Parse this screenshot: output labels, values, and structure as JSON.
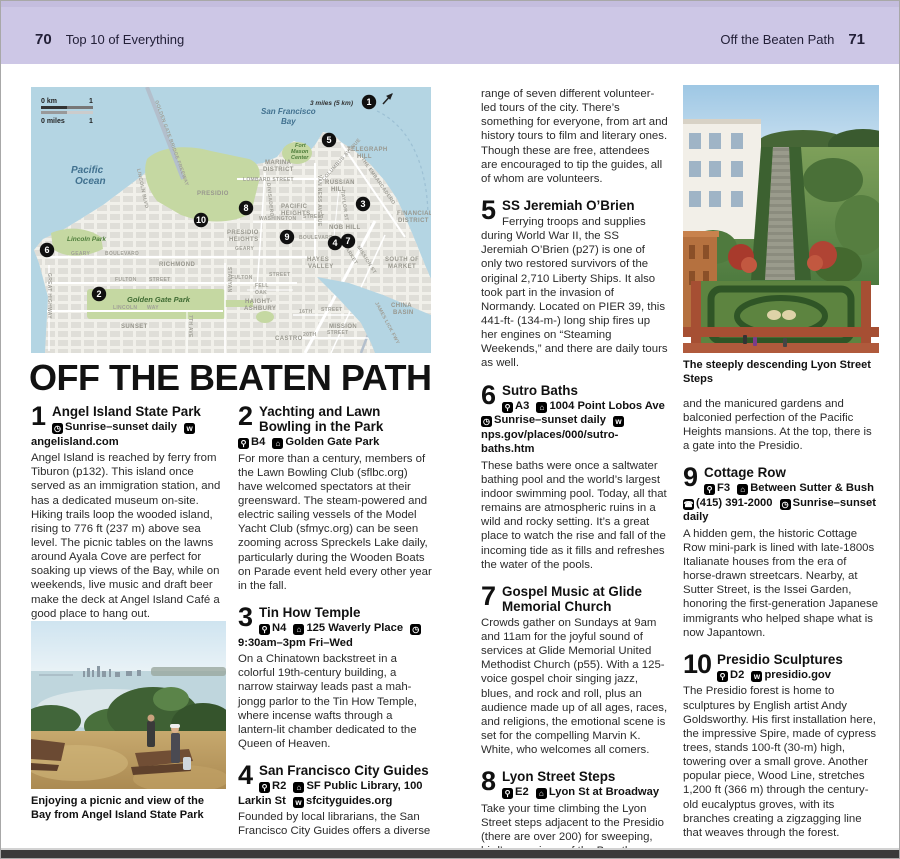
{
  "page": {
    "left_page_number": "70",
    "left_header": "Top 10 of Everything",
    "right_header": "Off the Beaten Path",
    "right_page_number": "71"
  },
  "title": "OFF THE BEATEN PATH",
  "icon_glyphs": {
    "pin": "⚲",
    "building": "⌂",
    "clock": "◷",
    "web": "w",
    "phone": "☎"
  },
  "captions": {
    "picnic": "Enjoying a picnic and view of the Bay from Angel Island State Park",
    "lyon": "The steeply descending Lyon Street Steps"
  },
  "entries": [
    {
      "num": "1",
      "title": "Angel Island State Park",
      "info": [
        {
          "icon": "clock-icon",
          "text": "Sunrise–sunset daily"
        },
        {
          "icon": "web-icon",
          "text": "angelisland.com"
        }
      ],
      "body": "Angel Island is reached by ferry from Tiburon (p132). This island once served as an immigration station, and has a dedicated museum on-site. Hiking trails loop the wooded island, rising to 776 ft (237 m) above sea level. The picnic tables on the lawns around Ayala Cove are perfect for soaking up views of the Bay, while on weekends, live music and draft beer make the deck at Angel Island Café a good place to hang out."
    },
    {
      "num": "2",
      "title": "Yachting and Lawn Bowling in the Park",
      "info": [
        {
          "icon": "map-pin-icon",
          "text": "B4"
        },
        {
          "icon": "building-icon",
          "text": "Golden Gate Park"
        }
      ],
      "body": "For more than a century, members of the Lawn Bowling Club (sflbc.org) have welcomed spectators at their greensward. The steam-powered and electric sailing vessels of the Model Yacht Club (sfmyc.org) can be seen zooming across Spreckels Lake daily, particularly during the Wooden Boats on Parade event held every other year in the fall."
    },
    {
      "num": "3",
      "title": "Tin How Temple",
      "info": [
        {
          "icon": "map-pin-icon",
          "text": "N4"
        },
        {
          "icon": "building-icon",
          "text": "125 Waverly Place"
        },
        {
          "icon": "clock-icon",
          "text": "9:30am–3pm Fri–Wed"
        }
      ],
      "body": "On a Chinatown backstreet in a colorful 19th-century building, a narrow stairway leads past a mah-jongg parlor to the Tin How Temple, where incense wafts through a lantern-lit chamber dedicated to the Queen of Heaven."
    },
    {
      "num": "4",
      "title": "San Francisco City Guides",
      "info": [
        {
          "icon": "map-pin-icon",
          "text": "R2"
        },
        {
          "icon": "building-icon",
          "text": "SF Public Library, 100 Larkin St"
        },
        {
          "icon": "web-icon",
          "text": "sfcityguides.org"
        }
      ],
      "body": "Founded by local librarians, the San Francisco City Guides offers a diverse",
      "body_cont": "range of seven different volunteer-led tours of the city. There’s something for everyone, from art and history tours to film and literary ones. Though these are free, attendees are encouraged to tip the guides, all of whom are volunteers."
    },
    {
      "num": "5",
      "title": "SS Jeremiah O’Brien",
      "info": [],
      "body": "Ferrying troops and supplies during World War II, the SS Jeremiah O’Brien (p27) is one of only two restored survivors of the original 2,710 Liberty Ships. It also took part in the invasion of Normandy. Located on PIER 39, this 441-ft- (134-m-) long ship fires up her engines on “Steaming Weekends,” and there are daily tours as well."
    },
    {
      "num": "6",
      "title": "Sutro Baths",
      "info": [
        {
          "icon": "map-pin-icon",
          "text": "A3"
        },
        {
          "icon": "building-icon",
          "text": "1004 Point Lobos Ave"
        },
        {
          "icon": "clock-icon",
          "text": "Sunrise–sunset daily"
        },
        {
          "icon": "web-icon",
          "text": "nps.gov/places/000/sutro-baths.htm"
        }
      ],
      "body": "These baths were once a saltwater bathing pool and the world’s largest indoor swimming pool. Today, all that remains are atmospheric ruins in a wild and rocky setting. It’s a great place to watch the rise and fall of the incoming tide as it fills and refreshes the water of the pools."
    },
    {
      "num": "7",
      "title": "Gospel Music at Glide Memorial Church",
      "info": [],
      "body": "Crowds gather on Sundays at 9am and 11am for the joyful sound of services at Glide Memorial United Methodist Church (p55). With a 125-voice gospel choir singing jazz, blues, and rock and roll, plus an audience made up of all ages, races, and religions, the emotional scene is set for the compelling Marvin K. White, who welcomes all comers."
    },
    {
      "num": "8",
      "title": "Lyon Street Steps",
      "info": [
        {
          "icon": "map-pin-icon",
          "text": "E2"
        },
        {
          "icon": "building-icon",
          "text": "Lyon St at Broadway"
        }
      ],
      "body": "Take your time climbing the Lyon Street steps adjacent to the Presidio (there are over 200) for sweeping, bird’s-eye views of the Bay, the Presidio, the Palace of Fine Arts,",
      "body_cont": "and the manicured gardens and balconied perfection of the Pacific Heights mansions. At the top, there is a gate into the Presidio."
    },
    {
      "num": "9",
      "title": "Cottage Row",
      "info": [
        {
          "icon": "map-pin-icon",
          "text": "F3"
        },
        {
          "icon": "building-icon",
          "text": "Between Sutter & Bush"
        },
        {
          "icon": "phone-icon",
          "text": "(415) 391-2000"
        },
        {
          "icon": "clock-icon",
          "text": "Sunrise–sunset daily"
        }
      ],
      "body": "A hidden gem, the historic Cottage Row mini-park is lined with late-1800s Italianate houses from the era of horse-drawn streetcars. Nearby, at Sutter Street, is the Issei Garden, honoring the first-generation Japanese immigrants who helped shape what is now Japantown."
    },
    {
      "num": "10",
      "title": "Presidio Sculptures",
      "info": [
        {
          "icon": "map-pin-icon",
          "text": "D2"
        },
        {
          "icon": "web-icon",
          "text": "presidio.gov"
        }
      ],
      "body": "The Presidio forest is home to sculptures by English artist Andy Goldsworthy. His first installation here, the impressive Spire, made of cypress trees, stands 100-ft (30-m) high, towering over a small grove. Another popular piece, Wood Line, stretches 1,200 ft (366 m) through the century-old eucalyptus groves, with its branches creating a zigzagging line that weaves through the forest."
    }
  ],
  "map": {
    "scale": {
      "km_label": "0 km",
      "km_value": "1",
      "miles_label": "0 miles",
      "miles_value": "1"
    },
    "distance_note": "3 miles (5 km)",
    "colors": {
      "water": "#b4d5e3",
      "land": "#f1f0ea",
      "park": "#c5d8a2",
      "marker": "#101010"
    },
    "markers": [
      {
        "n": "1",
        "x": 338,
        "y": 15
      },
      {
        "n": "2",
        "x": 68,
        "y": 207
      },
      {
        "n": "3",
        "x": 332,
        "y": 117
      },
      {
        "n": "4",
        "x": 304,
        "y": 156
      },
      {
        "n": "5",
        "x": 298,
        "y": 53
      },
      {
        "n": "6",
        "x": 16,
        "y": 163
      },
      {
        "n": "7",
        "x": 317,
        "y": 154
      },
      {
        "n": "8",
        "x": 215,
        "y": 121
      },
      {
        "n": "9",
        "x": 256,
        "y": 150
      },
      {
        "n": "10",
        "x": 170,
        "y": 133
      }
    ],
    "labels": [
      {
        "kind": "water",
        "text": "Pacific",
        "x": 40,
        "y": 86
      },
      {
        "kind": "water",
        "text": "Ocean",
        "x": 44,
        "y": 97
      },
      {
        "kind": "bay",
        "text": "San Francisco",
        "x": 230,
        "y": 27
      },
      {
        "kind": "bay",
        "text": "Bay",
        "x": 250,
        "y": 37
      },
      {
        "kind": "note",
        "text": "3 miles (5 km)",
        "x": 322,
        "y": 18
      },
      {
        "kind": "district",
        "text": "MARINA",
        "x": 234,
        "y": 77
      },
      {
        "kind": "district",
        "text": "DISTRICT",
        "x": 232,
        "y": 84
      },
      {
        "kind": "district",
        "text": "TELEGRAPH",
        "x": 316,
        "y": 64
      },
      {
        "kind": "district",
        "text": "HILL",
        "x": 326,
        "y": 71
      },
      {
        "kind": "district",
        "text": "RUSSIAN",
        "x": 294,
        "y": 97
      },
      {
        "kind": "district",
        "text": "HILL",
        "x": 300,
        "y": 104
      },
      {
        "kind": "district",
        "text": "PACIFIC",
        "x": 250,
        "y": 121
      },
      {
        "kind": "district",
        "text": "HEIGHTS",
        "x": 250,
        "y": 128
      },
      {
        "kind": "district",
        "text": "NOB HILL",
        "x": 298,
        "y": 142
      },
      {
        "kind": "district",
        "text": "FINANCIAL",
        "x": 366,
        "y": 128
      },
      {
        "kind": "district",
        "text": "DISTRICT",
        "x": 367,
        "y": 135
      },
      {
        "kind": "district",
        "text": "PRESIDIO",
        "x": 166,
        "y": 108
      },
      {
        "kind": "district",
        "text": "PRESIDIO",
        "x": 196,
        "y": 147
      },
      {
        "kind": "district",
        "text": "HEIGHTS",
        "x": 198,
        "y": 154
      },
      {
        "kind": "district",
        "text": "RICHMOND",
        "x": 128,
        "y": 179
      },
      {
        "kind": "district",
        "text": "HAYES",
        "x": 276,
        "y": 174
      },
      {
        "kind": "district",
        "text": "VALLEY",
        "x": 277,
        "y": 181
      },
      {
        "kind": "district",
        "text": "SOUTH OF",
        "x": 354,
        "y": 174
      },
      {
        "kind": "district",
        "text": "MARKET",
        "x": 357,
        "y": 181
      },
      {
        "kind": "district",
        "text": "HAIGHT-",
        "x": 214,
        "y": 216
      },
      {
        "kind": "district",
        "text": "ASHBURY",
        "x": 213,
        "y": 223
      },
      {
        "kind": "district",
        "text": "SUNSET",
        "x": 90,
        "y": 241
      },
      {
        "kind": "district",
        "text": "CASTRO",
        "x": 244,
        "y": 253
      },
      {
        "kind": "district",
        "text": "MISSION",
        "x": 298,
        "y": 241
      },
      {
        "kind": "district",
        "text": "CHINA",
        "x": 360,
        "y": 220
      },
      {
        "kind": "district",
        "text": "BASIN",
        "x": 362,
        "y": 227
      },
      {
        "kind": "park",
        "text": "Lincoln Park",
        "x": 36,
        "y": 154
      },
      {
        "kind": "gpark",
        "text": "Golden Gate Park",
        "x": 96,
        "y": 215
      },
      {
        "kind": "fort",
        "text": "Fort",
        "x": 264,
        "y": 60
      },
      {
        "kind": "fort",
        "text": "Mason",
        "x": 260,
        "y": 66
      },
      {
        "kind": "fort",
        "text": "Center",
        "x": 260,
        "y": 72
      },
      {
        "kind": "street",
        "text": "LOMBARD STREET",
        "x": 212,
        "y": 94
      },
      {
        "kind": "street",
        "text": "COLUMBUS AVENUE",
        "x": 293,
        "y": 94,
        "rotate": -48
      },
      {
        "kind": "street",
        "text": "THE EMBARCADERO",
        "x": 330,
        "y": 72,
        "rotate": 55
      },
      {
        "kind": "street",
        "text": "VAN NESS AVENUE",
        "x": 287,
        "y": 88,
        "rotate": 90
      },
      {
        "kind": "street",
        "text": "TAYLOR ST",
        "x": 310,
        "y": 104,
        "rotate": 82
      },
      {
        "kind": "street",
        "text": "WASHINGTON",
        "x": 228,
        "y": 133
      },
      {
        "kind": "street",
        "text": "STREET",
        "x": 272,
        "y": 131
      },
      {
        "kind": "street",
        "text": "BOULEVARD",
        "x": 268,
        "y": 152
      },
      {
        "kind": "street",
        "text": "GEARY",
        "x": 204,
        "y": 163
      },
      {
        "kind": "street",
        "text": "GEARY",
        "x": 40,
        "y": 168
      },
      {
        "kind": "street",
        "text": "BOULEVARD",
        "x": 74,
        "y": 168
      },
      {
        "kind": "street",
        "text": "FULTON",
        "x": 84,
        "y": 194
      },
      {
        "kind": "street",
        "text": "STREET",
        "x": 118,
        "y": 194
      },
      {
        "kind": "street",
        "text": "FULTON",
        "x": 200,
        "y": 192
      },
      {
        "kind": "street",
        "text": "STREET",
        "x": 238,
        "y": 189
      },
      {
        "kind": "street",
        "text": "FELL",
        "x": 224,
        "y": 200
      },
      {
        "kind": "street",
        "text": "OAK",
        "x": 224,
        "y": 207
      },
      {
        "kind": "street",
        "text": "LINCOLN",
        "x": 82,
        "y": 222
      },
      {
        "kind": "street",
        "text": "WAY",
        "x": 116,
        "y": 222
      },
      {
        "kind": "street",
        "text": "16TH",
        "x": 268,
        "y": 226
      },
      {
        "kind": "street",
        "text": "STREET",
        "x": 290,
        "y": 224
      },
      {
        "kind": "street",
        "text": "20TH",
        "x": 272,
        "y": 249
      },
      {
        "kind": "street",
        "text": "STREET",
        "x": 296,
        "y": 247
      },
      {
        "kind": "street",
        "text": "STANYAN",
        "x": 197,
        "y": 180,
        "rotate": 90
      },
      {
        "kind": "street",
        "text": "DIVISADERO",
        "x": 236,
        "y": 96,
        "rotate": 84
      },
      {
        "kind": "street",
        "text": "MARKET",
        "x": 312,
        "y": 158,
        "rotate": 58
      },
      {
        "kind": "street",
        "text": "MISSION ST",
        "x": 326,
        "y": 160,
        "rotate": 58
      },
      {
        "kind": "street",
        "text": "GOLDEN GATE BRIDGE FREEWAY",
        "x": 124,
        "y": 14,
        "rotate": 70
      },
      {
        "kind": "street",
        "text": "LINCOLN BLVD",
        "x": 106,
        "y": 82,
        "rotate": 78
      },
      {
        "kind": "street",
        "text": "GREAT HIGHWAY",
        "x": 17,
        "y": 186,
        "rotate": 90
      },
      {
        "kind": "street",
        "text": "7TH AVE",
        "x": 158,
        "y": 228,
        "rotate": 90
      },
      {
        "kind": "street",
        "text": "JAMES LICK FWY",
        "x": 344,
        "y": 216,
        "rotate": 62
      }
    ]
  }
}
